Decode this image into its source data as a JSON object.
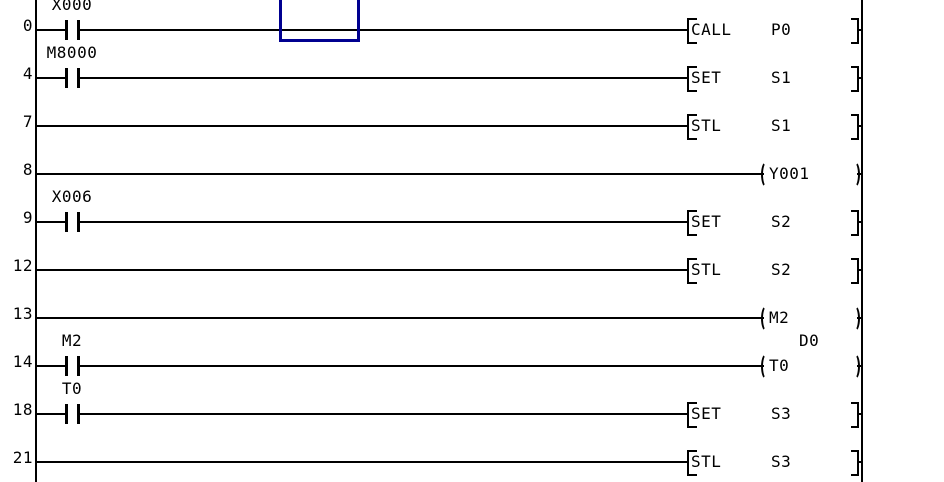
{
  "app": {
    "title": "PLC ladder program editor"
  },
  "colors": {
    "background": "#ffffff",
    "wire": "#000000",
    "text": "#000000",
    "cursor": "#000090"
  },
  "ladder": {
    "rungs": [
      {
        "step": "0",
        "contact": {
          "label": "X000"
        },
        "output": {
          "kind": "instruction",
          "mnemonic": "CALL",
          "operand": "P0"
        }
      },
      {
        "step": "4",
        "contact": {
          "label": "M8000"
        },
        "output": {
          "kind": "instruction",
          "mnemonic": "SET",
          "operand": "S1"
        }
      },
      {
        "step": "7",
        "contact": null,
        "output": {
          "kind": "instruction",
          "mnemonic": "STL",
          "operand": "S1"
        }
      },
      {
        "step": "8",
        "contact": null,
        "output": {
          "kind": "coil",
          "device": "Y001"
        }
      },
      {
        "step": "9",
        "contact": {
          "label": "X006"
        },
        "output": {
          "kind": "instruction",
          "mnemonic": "SET",
          "operand": "S2"
        }
      },
      {
        "step": "12",
        "contact": null,
        "output": {
          "kind": "instruction",
          "mnemonic": "STL",
          "operand": "S2"
        }
      },
      {
        "step": "13",
        "contact": null,
        "output": {
          "kind": "coil",
          "device": "M2"
        }
      },
      {
        "step": "14",
        "contact": {
          "label": "M2"
        },
        "output": {
          "kind": "coil",
          "device": "T0",
          "value_label": "D0"
        }
      },
      {
        "step": "18",
        "contact": {
          "label": "T0"
        },
        "output": {
          "kind": "instruction",
          "mnemonic": "SET",
          "operand": "S3"
        }
      },
      {
        "step": "21",
        "contact": null,
        "output": {
          "kind": "instruction",
          "mnemonic": "STL",
          "operand": "S3"
        }
      }
    ],
    "cursor": {
      "present": true
    }
  }
}
